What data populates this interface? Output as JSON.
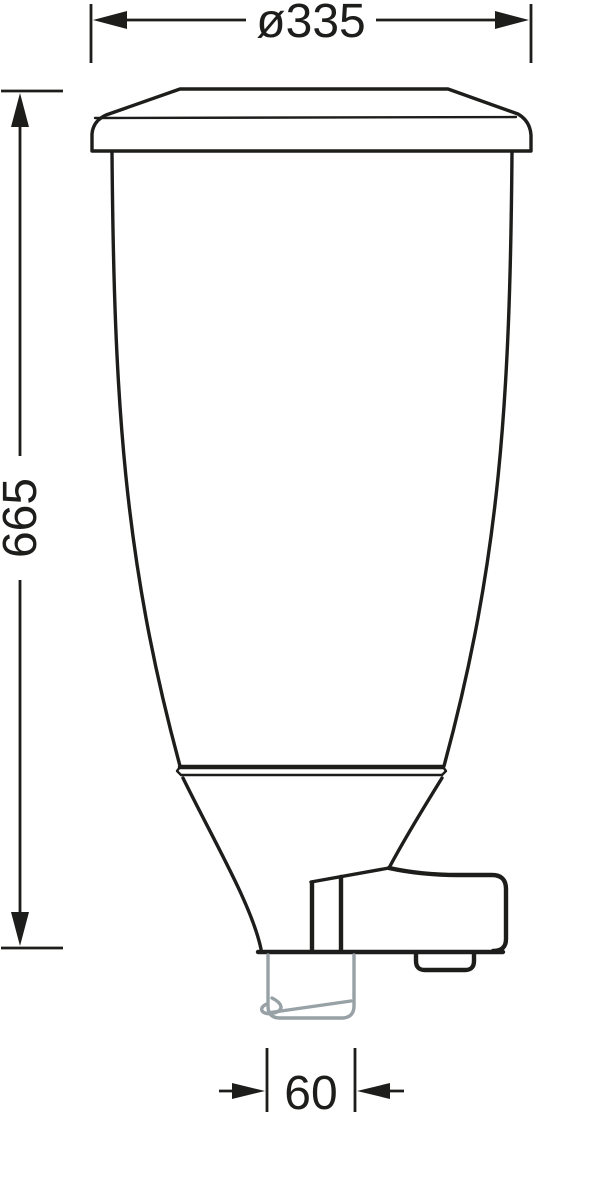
{
  "drawing": {
    "kind": "technical-dimension-drawing",
    "subject": "wall-hung cistern / hopper with outlet pipe and flush-valve bracket, front view",
    "dimensions": {
      "diameter_top": "ø335",
      "height": "665",
      "outlet_width": "60"
    },
    "colors": {
      "line": "#1d1d1b",
      "outlet_pipe": "#97a1a6",
      "background": "#ffffff"
    }
  }
}
